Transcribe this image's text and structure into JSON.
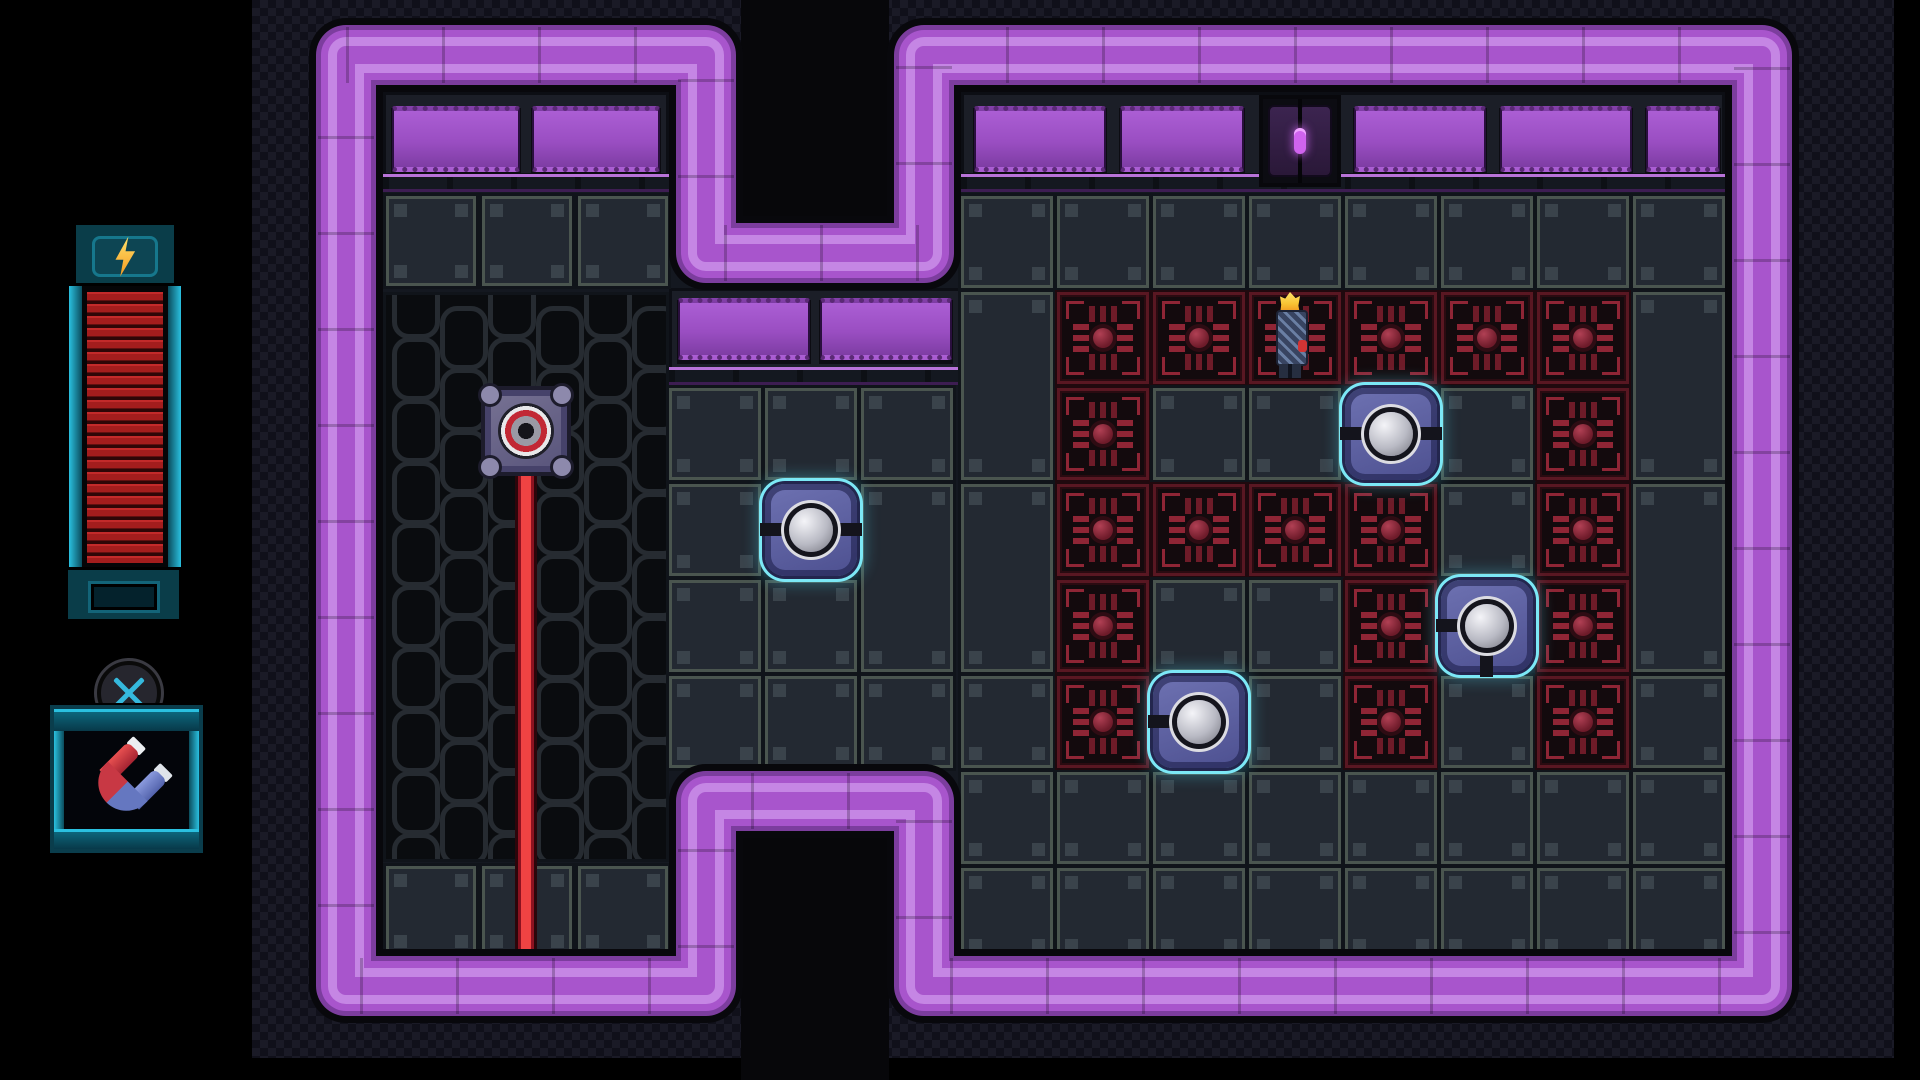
{
  "meta": {
    "app": "pixel-puzzle-room",
    "view": "dungeon-room"
  },
  "colors": {
    "wall_outline": "#08080c",
    "wall_dark": "#7c3d9e",
    "wall_main": "#a855cc",
    "wall_light": "#c586e4",
    "room_floor_bg": "#141820",
    "hole_black": "#07070a",
    "tile_face": "#232932",
    "tile_frame": "#4a554f",
    "hazard_frame": "#591722",
    "hazard_accent": "#8f2535",
    "node_base": "#5b5e9c",
    "node_glow": "#7ce8f6",
    "laser_core": "#ef4343",
    "laser_edge": "#8c1220",
    "hud_teal": "#0d6d84",
    "hud_teal_bright": "#2ac0e0",
    "energy_red": "#a82020",
    "bolt_yellow": "#ffd24a",
    "door_oval": "#cf63ee",
    "char_flame": "#f8c232"
  },
  "hud": {
    "energy_bar": {
      "icon": "lightning-bolt-icon",
      "segments": 23,
      "frame": {
        "x": 73,
        "y": 222,
        "w": 104,
        "h": 64
      },
      "body": {
        "x": 69,
        "y": 286,
        "w": 112,
        "h": 281
      },
      "cap": {
        "x": 65,
        "y": 567,
        "w": 117,
        "h": 55
      }
    },
    "item_slot": {
      "button_icon": "x-button-icon",
      "button": {
        "cx": 133,
        "cy": 697,
        "r": 36
      },
      "box": {
        "x": 50,
        "y": 705,
        "w": 153,
        "h": 148
      },
      "item_icon": "magnet-icon"
    }
  },
  "scene": {
    "checker": {
      "x": 252,
      "y": 0,
      "w": 1642,
      "h": 1058
    },
    "wall_path": "M346,55 H706 V253 H924 V55 H1762 V986 H924 V801 H706 V986 H346 Z",
    "wall_strokes": [
      {
        "w": 74,
        "color": "#08080c"
      },
      {
        "w": 60,
        "color": "#7c3d9e"
      },
      {
        "w": 50,
        "color": "#a855cc"
      },
      {
        "w": 36,
        "color": "#c586e4"
      },
      {
        "w": 18,
        "color": "#a855cc"
      }
    ],
    "wall_seam": {
      "w": 56,
      "color": "rgba(0,0,0,0.22)",
      "dash": "3 93"
    },
    "holes": [
      {
        "x": 741,
        "y": 0,
        "w": 148,
        "h": 222
      },
      {
        "x": 741,
        "y": 832,
        "w": 148,
        "h": 248
      }
    ],
    "headers": [
      {
        "name": "left-header",
        "strip": {
          "x": 383,
          "y": 92,
          "w": 286,
          "h": 84
        },
        "windows": [
          {
            "x": 392,
            "y": 106,
            "w": 128,
            "h": 66
          },
          {
            "x": 532,
            "y": 106,
            "w": 128,
            "h": 66
          }
        ],
        "lip": {
          "x": 383,
          "y": 174,
          "w": 286,
          "h": 18
        }
      },
      {
        "name": "right-header",
        "strip": {
          "x": 961,
          "y": 92,
          "w": 764,
          "h": 84
        },
        "windows": [
          {
            "x": 974,
            "y": 106,
            "w": 132,
            "h": 66
          },
          {
            "x": 1120,
            "y": 106,
            "w": 124,
            "h": 66
          },
          {
            "x": 1354,
            "y": 106,
            "w": 132,
            "h": 66
          },
          {
            "x": 1500,
            "y": 106,
            "w": 132,
            "h": 66
          },
          {
            "x": 1646,
            "y": 106,
            "w": 74,
            "h": 66
          }
        ],
        "lip": {
          "x": 961,
          "y": 174,
          "w": 764,
          "h": 18
        }
      },
      {
        "name": "middle-shelf",
        "strip": {
          "x": 669,
          "y": 288,
          "w": 292,
          "h": 82
        },
        "windows": [
          {
            "x": 678,
            "y": 298,
            "w": 132,
            "h": 62
          },
          {
            "x": 820,
            "y": 298,
            "w": 132,
            "h": 62
          }
        ],
        "lip": {
          "x": 669,
          "y": 367,
          "w": 292,
          "h": 18
        }
      }
    ],
    "door": {
      "x": 1259,
      "y": 95,
      "w": 82,
      "h": 92
    },
    "left_chamber": {
      "tile_rows": [
        {
          "y": 196,
          "h": 90,
          "xs": [
            386,
            482,
            578
          ],
          "w": 90
        },
        {
          "y": 866,
          "h": 90,
          "xs": [
            386,
            482,
            578
          ],
          "w": 90
        }
      ],
      "grate": {
        "x": 383,
        "y": 292,
        "w": 286,
        "h": 570,
        "ring_w": 38,
        "ring_h": 54,
        "px": 48,
        "py": 62
      },
      "laser_turret": {
        "x": 481,
        "y": 386,
        "w": 90,
        "h": 90
      },
      "laser_beam": {
        "x": 515,
        "y": 470,
        "w": 22,
        "h": 488
      }
    },
    "middle_section": {
      "cols_x": [
        669,
        765,
        861
      ],
      "rows_y": [
        388,
        484,
        580,
        676
      ],
      "tile": 92,
      "skip_cells": [
        {
          "x": 765,
          "y": 484
        }
      ],
      "tall_cells": [
        {
          "x": 861,
          "y": 484,
          "h": 188
        }
      ]
    },
    "right_chamber": {
      "tile": 92,
      "pitch": 96,
      "top_row": {
        "y": 196,
        "xs": [
          961,
          1057,
          1153,
          1249,
          1345,
          1441,
          1537,
          1633
        ]
      },
      "bottom_rows": [
        {
          "y": 772,
          "xs": [
            961,
            1057,
            1153,
            1249,
            1345,
            1441,
            1537,
            1633
          ]
        },
        {
          "y": 868,
          "xs": [
            961,
            1057,
            1153,
            1249,
            1345,
            1441,
            1537,
            1633
          ]
        }
      ],
      "side_tall_cols": [
        {
          "x": 961,
          "cells": [
            {
              "y": 292,
              "h": 188
            },
            {
              "y": 484,
              "h": 188
            },
            {
              "y": 676,
              "h": 92
            }
          ]
        },
        {
          "x": 1633,
          "cells": [
            {
              "y": 292,
              "h": 188
            },
            {
              "y": 484,
              "h": 188
            },
            {
              "y": 676,
              "h": 92
            }
          ]
        }
      ],
      "hazard_grid": {
        "x0": 1057,
        "y0": 292,
        "legend": {
          "R": "hazard-tile",
          ".": "floor-tile",
          "x": "node-cell"
        },
        "pattern": [
          [
            "R",
            "R",
            "R",
            "R",
            "R",
            "R"
          ],
          [
            "R",
            ".",
            ".",
            "x",
            ".",
            "R"
          ],
          [
            "R",
            "R",
            "R",
            "R",
            ".",
            "R"
          ],
          [
            "R",
            ".",
            ".",
            "R",
            "x",
            "R"
          ],
          [
            "R",
            "x",
            ".",
            "R",
            ".",
            "R"
          ]
        ]
      }
    },
    "nodes": [
      {
        "id": "node-1",
        "x": 765,
        "y": 484,
        "bars": [
          "left",
          "right"
        ]
      },
      {
        "id": "node-2",
        "x": 1345,
        "y": 388,
        "bars": [
          "left",
          "right"
        ]
      },
      {
        "id": "node-3",
        "x": 1153,
        "y": 676,
        "bars": [
          "left"
        ]
      },
      {
        "id": "node-4",
        "x": 1441,
        "y": 580,
        "bars": [
          "left",
          "down"
        ]
      }
    ],
    "character": {
      "x": 1275,
      "y": 292,
      "w": 30,
      "h": 86
    }
  }
}
